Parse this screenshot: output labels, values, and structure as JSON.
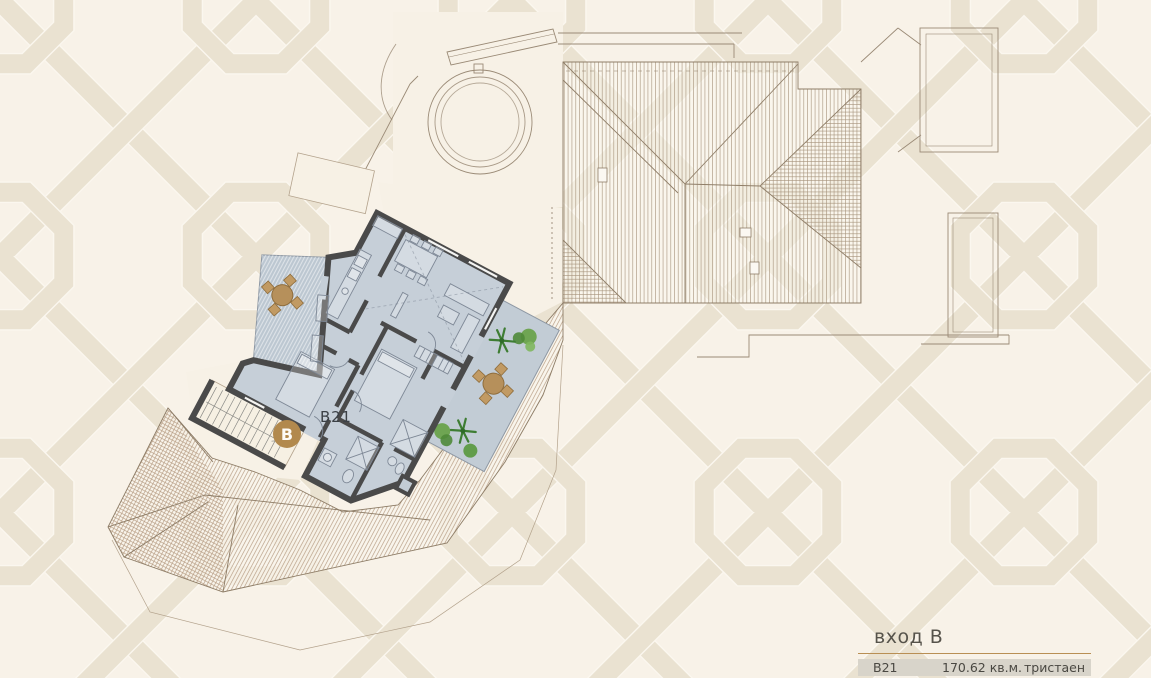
{
  "plan": {
    "badge_letter": "B",
    "unit_label": "B21"
  },
  "legend": {
    "title": "вход В",
    "row": {
      "unit": "B21",
      "area": "170.62 кв.м.",
      "type": "тристаен"
    }
  },
  "colors": {
    "background": "#f8f2e8",
    "pattern_band": "#eae2d1",
    "apartment_fill": "#c6cfd8",
    "terrace_fill": "#bcc7d1",
    "wall": "#4a4a4a",
    "roof_hatch": "#a5927a",
    "accent_gold": "#b2894d",
    "legend_rule": "#b98f54",
    "legend_row_bg": "#d8d4ca",
    "text": "#4a4842"
  }
}
